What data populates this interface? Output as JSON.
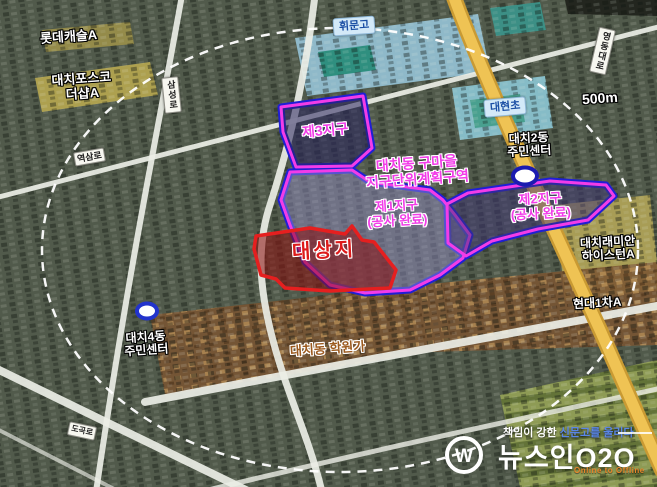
{
  "map": {
    "scale_label": "500m",
    "road_labels": {
      "samseongro": "삼성로",
      "yeoksamro": "역삼로",
      "yeongdongdaero": "영동대로",
      "dogokro": "도곡로"
    },
    "place_labels": {
      "lotte_castle": "롯데캐슬A",
      "posco_l1": "대치포스코",
      "posco_l2": "더샵A",
      "hwimun_high": "휘문고",
      "daehyun_elem": "대현초",
      "daechi2_l1": "대치2동",
      "daechi2_l2": "주민센터",
      "daechi4_l1": "대치4동",
      "daechi4_l2": "주민센터",
      "raemian_l1": "대치래미안",
      "raemian_l2": "하이스턴A",
      "hyundai1cha": "현대1차A",
      "hagwon_street": "대치동 학원가"
    },
    "zone_labels": {
      "district_l1": "대치동 구마을",
      "district_l2": "지구단위계획구역",
      "zone3": "제3지구",
      "zone1_l1": "제1지구",
      "zone1_l2": "(공사 완료)",
      "zone2_l1": "제2지구",
      "zone2_l2": "(공사 완료)",
      "target_site": "대상지"
    },
    "colors": {
      "zone_outline_magenta": "#f23ce8",
      "district_boundary_blue": "#1f1fd4",
      "target_red": "#e02020",
      "yeongdong_road_yellow": "#efc354",
      "hagwon_text_brown": "#9c5a1e",
      "school_label_blue": "#1b4fa4"
    }
  },
  "watermark": {
    "tagline_white": "책임이 강한",
    "tagline_blue": "신문고를 울리다",
    "brand": "뉴스인O2O",
    "subtitle": "Online to Offline",
    "logo_letter": "W"
  }
}
